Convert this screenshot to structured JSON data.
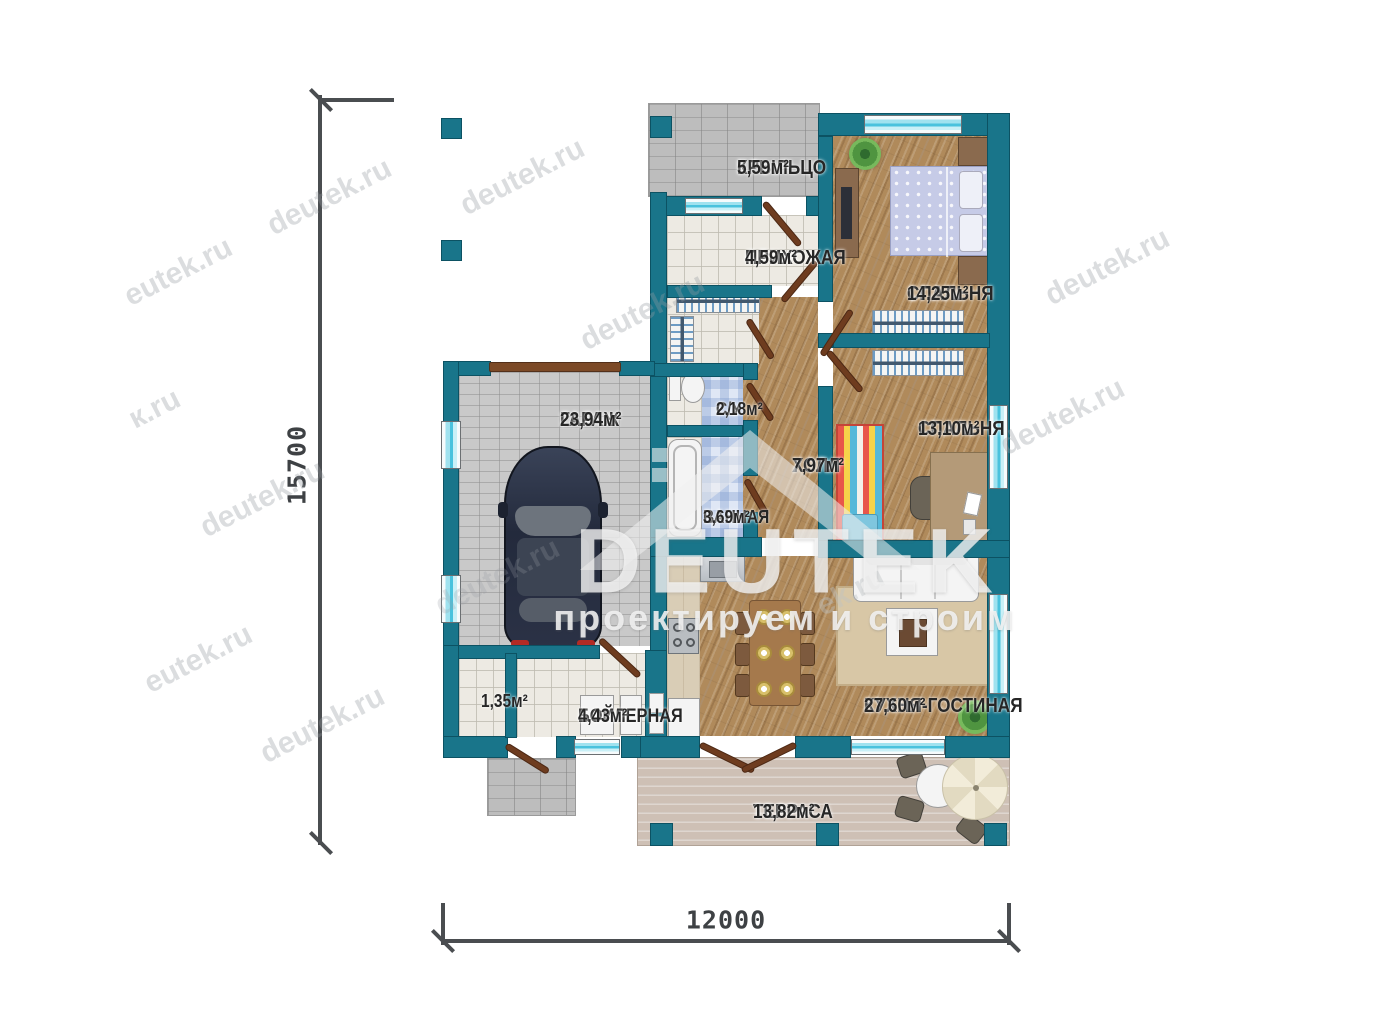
{
  "plan": {
    "rooms": [
      {
        "key": "porch",
        "name": "КРЫЛЬЦО",
        "area": "5,59м²"
      },
      {
        "key": "hallway",
        "name": "ПРИХОЖАЯ",
        "area": "4,59м²"
      },
      {
        "key": "bedroom1",
        "name": "СПАЛЬНЯ",
        "area": "14,25м²"
      },
      {
        "key": "wc",
        "name": "С/У",
        "area": "2,18м²"
      },
      {
        "key": "bathroom",
        "name": "ВАННАЯ",
        "area": "3,69м²"
      },
      {
        "key": "hall",
        "name": "ХОЛЛ",
        "area": "7,97м²"
      },
      {
        "key": "bedroom2",
        "name": "СПАЛЬНЯ",
        "area": "13,10м²"
      },
      {
        "key": "garage",
        "name": "ГАРАЖ",
        "area": "23,94м²"
      },
      {
        "key": "storage",
        "name": "",
        "area": "1,35м²"
      },
      {
        "key": "boiler",
        "name": "БОЙЛЕРНАЯ",
        "area": "4,43м²"
      },
      {
        "key": "kitchen_living",
        "name": "КУХНЯ-ГОСТИНАЯ",
        "area": "27,60м²"
      },
      {
        "key": "terrace",
        "name": "ТЕРРАСА",
        "area": "13,82м²"
      }
    ],
    "dimensions": {
      "vertical": "15700",
      "horizontal": "12000"
    }
  },
  "branding": {
    "logo": "DEUTEK",
    "tagline": "проектируем и строим",
    "watermarks": {
      "primary": "deutek.ru",
      "secondary": "eutek.ru",
      "frag_k": "к.ru",
      "frag_ek": "ek.ru"
    }
  },
  "colors": {
    "wall": "#19758a",
    "window_glass": "#49c2dd",
    "door": "#6e3c1f",
    "wood_floor": "#b08a5b"
  }
}
